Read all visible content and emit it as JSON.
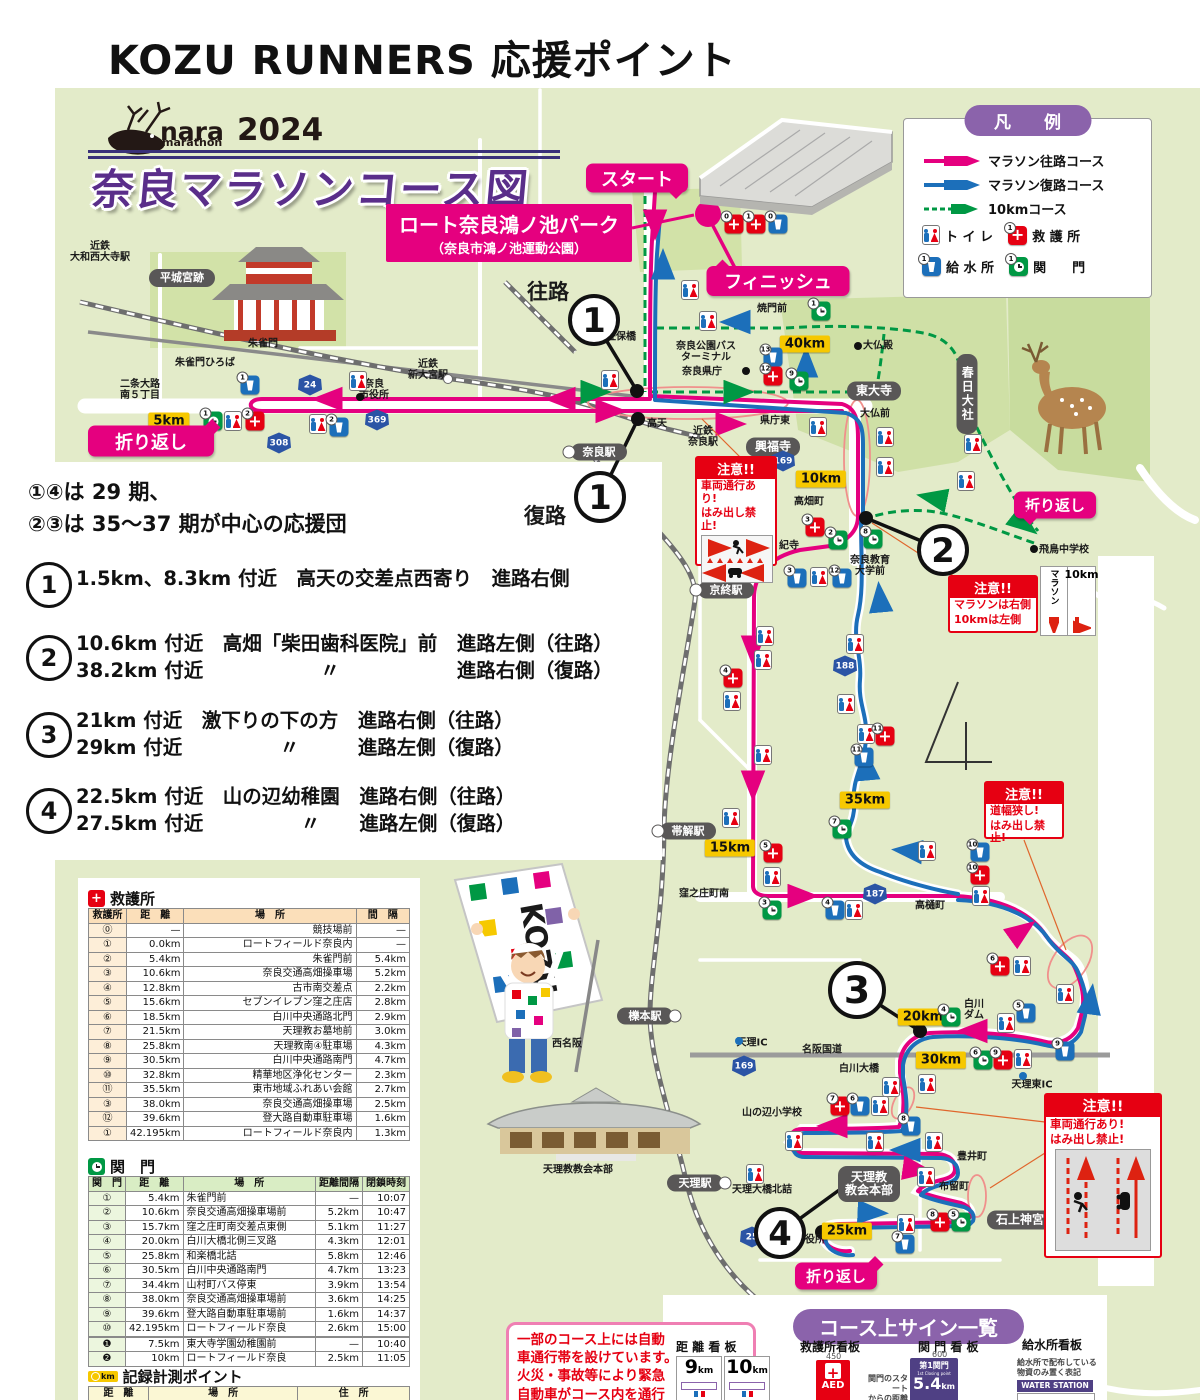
{
  "page": {
    "title": "KOZU RUNNERS 応援ポイント"
  },
  "map": {
    "logo": {
      "nara": "nara",
      "marathon": "marathon",
      "year": "2024"
    },
    "course_title": "奈良マラソンコース図",
    "venue": {
      "name": "ロート奈良鴻ノ池パーク",
      "sub": "（奈良市鴻ノ池運動公園）"
    },
    "legend": {
      "title": "凡　例",
      "items": [
        {
          "type": "pink-arrow",
          "label": "マラソン往路コース"
        },
        {
          "type": "blue-arrow",
          "label": "マラソン復路コース"
        },
        {
          "type": "green-dashed-arrow",
          "label": "10kmコース"
        }
      ],
      "icon1": {
        "label": "ト イ レ"
      },
      "icon2": {
        "label": "救 護 所"
      },
      "icon3": {
        "label": "給 水 所"
      },
      "icon4": {
        "label": "関　　門"
      }
    },
    "notes": [
      "①④は 29 期、",
      "②③は 35～37 期が中心の応援団"
    ],
    "points": [
      {
        "num": "1",
        "lines": [
          "1.5km、8.3km 付近　高天の交差点西寄り　進路右側"
        ]
      },
      {
        "num": "2",
        "lines": [
          "10.6km 付近　高畑「柴田歯科医院」前　進路左側（往路）",
          "38.2km 付近　　　　　　〃　　　　　　進路右側（復路）"
        ]
      },
      {
        "num": "3",
        "lines": [
          "21km 付近　激下りの下の方　進路右側（往路）",
          "29km 付近　　　　　〃　　　進路左側（復路）"
        ]
      },
      {
        "num": "4",
        "lines": [
          "22.5km 付近　山の辺幼稚園　進路右側（往路）",
          "27.5km 付近　　　　　〃　　進路左側（復路）"
        ]
      }
    ],
    "pills": [
      {
        "t": "スタート",
        "x": 637,
        "y": 178,
        "w": 102,
        "h": 29,
        "fs": 18,
        "tail": "br"
      },
      {
        "t": "フィニッシュ",
        "x": 778,
        "y": 281,
        "w": 143,
        "h": 30,
        "fs": 18,
        "tail": "tl"
      },
      {
        "t": "折り返し",
        "x": 151,
        "y": 441,
        "w": 126,
        "h": 31,
        "fs": 18,
        "tail": "tr"
      },
      {
        "t": "折り返し",
        "x": 1055,
        "y": 505,
        "w": 82,
        "h": 27,
        "fs": 15,
        "tail": "bl"
      },
      {
        "t": "折り返し",
        "x": 836,
        "y": 1276,
        "w": 82,
        "h": 27,
        "fs": 15,
        "tail": "tr"
      }
    ],
    "direction_labels": [
      {
        "t": "往路",
        "x": 548,
        "y": 293,
        "fs": 21
      },
      {
        "t": "復路",
        "x": 545,
        "y": 517,
        "fs": 21
      }
    ],
    "circles": [
      {
        "n": "1",
        "x": 594,
        "y": 320,
        "lx": 637,
        "ly": 391
      },
      {
        "n": "1",
        "x": 600,
        "y": 497,
        "lx": 638,
        "ly": 419
      },
      {
        "n": "2",
        "x": 943,
        "y": 550,
        "lx": 866,
        "ly": 518
      },
      {
        "n": "3",
        "x": 857,
        "y": 990,
        "lx": 920,
        "ly": 1031
      },
      {
        "n": "4",
        "x": 780,
        "y": 1233,
        "lx": 853,
        "ly": 1180,
        "dx": 822,
        "dy": 1232
      }
    ],
    "warnings": {
      "w1": {
        "title": "注意!!",
        "lines": [
          "車両通行あり!",
          "はみ出し禁止!"
        ]
      },
      "w2": {
        "title": "注意!!",
        "lines": [
          "マラソンは右側",
          "10kmは左側"
        ],
        "sign_col1": "マラソン",
        "sign_col2": "10km"
      },
      "w3": {
        "title": "注意!!",
        "lines": [
          "道幅狭し!",
          "はみ出し禁止!"
        ]
      },
      "w4": {
        "title": "注意!!",
        "lines": [
          "車両通行あり!",
          "はみ出し禁止!"
        ]
      }
    },
    "kms": [
      {
        "t": "5km",
        "x": 169,
        "y": 421
      },
      {
        "t": "40km",
        "x": 805,
        "y": 344
      },
      {
        "t": "10km",
        "x": 821,
        "y": 479
      },
      {
        "t": "15km",
        "x": 730,
        "y": 848
      },
      {
        "t": "35km",
        "x": 865,
        "y": 800
      },
      {
        "t": "20km",
        "x": 923,
        "y": 1017
      },
      {
        "t": "30km",
        "x": 941,
        "y": 1060
      },
      {
        "t": "25km",
        "x": 847,
        "y": 1231
      }
    ],
    "shields": [
      {
        "n": "24",
        "x": 310,
        "y": 385
      },
      {
        "n": "308",
        "x": 279,
        "y": 443
      },
      {
        "n": "369",
        "x": 377,
        "y": 420
      },
      {
        "n": "169",
        "x": 783,
        "y": 461
      },
      {
        "n": "188",
        "x": 845,
        "y": 666
      },
      {
        "n": "187",
        "x": 875,
        "y": 894
      },
      {
        "n": "169",
        "x": 744,
        "y": 1066
      },
      {
        "n": "25",
        "x": 752,
        "y": 1237
      }
    ],
    "plates": [
      {
        "t": "平城宮跡",
        "x": 182,
        "y": 278,
        "w": 66,
        "h": 18,
        "fs": 11
      },
      {
        "t": "興福寺",
        "x": 773,
        "y": 447,
        "w": 54,
        "h": 19,
        "fs": 12
      },
      {
        "t": "東大寺",
        "x": 874,
        "y": 391,
        "w": 54,
        "h": 19,
        "fs": 12
      },
      {
        "t": "春日大社",
        "x": 967,
        "y": 394,
        "w": 21,
        "h": 80,
        "fs": 12,
        "v": 1
      },
      {
        "t": "石上神宮",
        "x": 1020,
        "y": 1220,
        "w": 66,
        "h": 19,
        "fs": 12
      },
      {
        "t": "天理教\n教会本部",
        "x": 869,
        "y": 1184,
        "w": 62,
        "h": 36,
        "fs": 12
      },
      {
        "t": "奈良駅",
        "x": 599,
        "y": 452,
        "w": 56,
        "h": 17,
        "fs": 11,
        "dot": "l"
      },
      {
        "t": "京終駅",
        "x": 726,
        "y": 590,
        "w": 56,
        "h": 17,
        "fs": 11,
        "dot": "l"
      },
      {
        "t": "帯解駅",
        "x": 688,
        "y": 831,
        "w": 56,
        "h": 17,
        "fs": 11,
        "dot": "l"
      },
      {
        "t": "櫟本駅",
        "x": 645,
        "y": 1016,
        "w": 56,
        "h": 17,
        "fs": 11,
        "dot": "r"
      },
      {
        "t": "天理駅",
        "x": 695,
        "y": 1183,
        "w": 56,
        "h": 17,
        "fs": 11,
        "dot": "r"
      }
    ],
    "labels": [
      {
        "t": "近鉄\n大和西大寺駅",
        "x": 100,
        "y": 252,
        "fs": 10
      },
      {
        "t": "二条大路\n南５丁目",
        "x": 140,
        "y": 390,
        "fs": 10
      },
      {
        "t": "朱雀門ひろば",
        "x": 205,
        "y": 363,
        "fs": 10
      },
      {
        "t": "朱雀門",
        "x": 263,
        "y": 344,
        "fs": 10
      },
      {
        "t": "奈良\n市役所",
        "x": 374,
        "y": 390,
        "fs": 10
      },
      {
        "t": "近鉄\n新大宮駅",
        "x": 428,
        "y": 370,
        "fs": 10
      },
      {
        "t": "蓮佐保橋",
        "x": 616,
        "y": 337,
        "fs": 10
      },
      {
        "t": "高天",
        "x": 657,
        "y": 424,
        "fs": 10
      },
      {
        "t": "近鉄\n奈良駅",
        "x": 703,
        "y": 437,
        "fs": 10
      },
      {
        "t": "県庁東",
        "x": 775,
        "y": 421,
        "fs": 10
      },
      {
        "t": "大仏前",
        "x": 875,
        "y": 414,
        "fs": 10
      },
      {
        "t": "大仏殿",
        "x": 878,
        "y": 346,
        "fs": 10
      },
      {
        "t": "焼門前",
        "x": 772,
        "y": 309,
        "fs": 10
      },
      {
        "t": "奈良公園バス\nターミナル",
        "x": 706,
        "y": 352,
        "fs": 10
      },
      {
        "t": "奈良県庁",
        "x": 702,
        "y": 372,
        "fs": 10
      },
      {
        "t": "高畑町",
        "x": 809,
        "y": 502,
        "fs": 10
      },
      {
        "t": "紀寺",
        "x": 789,
        "y": 546,
        "fs": 10
      },
      {
        "t": "奈良教育\n大学前",
        "x": 870,
        "y": 566,
        "fs": 10
      },
      {
        "t": "飛鳥中学校",
        "x": 1064,
        "y": 550,
        "fs": 10
      },
      {
        "t": "窪之庄町南",
        "x": 704,
        "y": 894,
        "fs": 10
      },
      {
        "t": "高樋町",
        "x": 930,
        "y": 906,
        "fs": 10
      },
      {
        "t": "天理IC",
        "x": 752,
        "y": 1043,
        "fs": 10
      },
      {
        "t": "名阪国道",
        "x": 822,
        "y": 1050,
        "fs": 10
      },
      {
        "t": "白川大橋",
        "x": 859,
        "y": 1069,
        "fs": 10
      },
      {
        "t": "白川\nダム",
        "x": 974,
        "y": 1010,
        "fs": 10
      },
      {
        "t": "天理東IC",
        "x": 1032,
        "y": 1085,
        "fs": 10
      },
      {
        "t": "山の辺小学校",
        "x": 772,
        "y": 1113,
        "fs": 10
      },
      {
        "t": "豊井町",
        "x": 972,
        "y": 1157,
        "fs": 10
      },
      {
        "t": "布留町",
        "x": 954,
        "y": 1187,
        "fs": 10
      },
      {
        "t": "天理大橋北詰",
        "x": 762,
        "y": 1190,
        "fs": 10
      },
      {
        "t": "西名阪",
        "x": 567,
        "y": 1044,
        "fs": 10
      },
      {
        "t": "役所",
        "x": 815,
        "y": 1240,
        "fs": 10
      },
      {
        "t": "天理教教会本部",
        "x": 578,
        "y": 1170,
        "fs": 10
      }
    ],
    "dots": [
      {
        "x": 858,
        "y": 346
      },
      {
        "x": 746,
        "y": 371
      },
      {
        "x": 1034,
        "y": 549
      },
      {
        "x": 360,
        "y": 397
      },
      {
        "x": 800,
        "y": 1238
      },
      {
        "x": 448,
        "y": 379,
        "c": "w"
      },
      {
        "x": 739,
        "y": 1041,
        "c": "b"
      },
      {
        "x": 1023,
        "y": 1076,
        "c": "b"
      }
    ],
    "markers": [
      {
        "k": "t",
        "x": 690,
        "y": 290
      },
      {
        "k": "t",
        "x": 708,
        "y": 321
      },
      {
        "k": "a",
        "n": "0",
        "x": 734,
        "y": 224
      },
      {
        "k": "a",
        "n": "1",
        "x": 756,
        "y": 224
      },
      {
        "k": "w",
        "n": "0",
        "x": 778,
        "y": 224
      },
      {
        "k": "g",
        "n": "1",
        "x": 821,
        "y": 311
      },
      {
        "k": "g",
        "n": "9",
        "x": 799,
        "y": 381
      },
      {
        "k": "w",
        "n": "13",
        "x": 773,
        "y": 357
      },
      {
        "k": "a",
        "n": "12",
        "x": 773,
        "y": 376
      },
      {
        "k": "t",
        "x": 818,
        "y": 427
      },
      {
        "k": "t",
        "x": 885,
        "y": 437
      },
      {
        "k": "t",
        "x": 885,
        "y": 467
      },
      {
        "k": "t",
        "x": 973,
        "y": 444
      },
      {
        "k": "t",
        "x": 966,
        "y": 481
      },
      {
        "k": "a",
        "n": "3",
        "x": 815,
        "y": 527
      },
      {
        "k": "g",
        "n": "2",
        "x": 838,
        "y": 540
      },
      {
        "k": "g",
        "n": "8",
        "x": 873,
        "y": 539
      },
      {
        "k": "w",
        "n": "3",
        "x": 797,
        "y": 578
      },
      {
        "k": "t",
        "x": 819,
        "y": 577
      },
      {
        "k": "w",
        "n": "12",
        "x": 842,
        "y": 578
      },
      {
        "k": "t",
        "x": 610,
        "y": 380
      },
      {
        "k": "w",
        "n": "1",
        "x": 250,
        "y": 385
      },
      {
        "k": "t",
        "x": 358,
        "y": 381
      },
      {
        "k": "g",
        "n": "1",
        "x": 213,
        "y": 421
      },
      {
        "k": "t",
        "x": 233,
        "y": 421
      },
      {
        "k": "a",
        "n": "2",
        "x": 255,
        "y": 421
      },
      {
        "k": "t",
        "x": 318,
        "y": 424
      },
      {
        "k": "w",
        "n": "2",
        "x": 339,
        "y": 427
      },
      {
        "k": "t",
        "x": 765,
        "y": 636
      },
      {
        "k": "t",
        "x": 763,
        "y": 660
      },
      {
        "k": "a",
        "n": "4",
        "x": 733,
        "y": 678
      },
      {
        "k": "t",
        "x": 732,
        "y": 701
      },
      {
        "k": "t",
        "x": 763,
        "y": 755
      },
      {
        "k": "t",
        "x": 731,
        "y": 818
      },
      {
        "k": "a",
        "n": "5",
        "x": 773,
        "y": 853
      },
      {
        "k": "t",
        "x": 772,
        "y": 877
      },
      {
        "k": "g",
        "n": "7",
        "x": 842,
        "y": 829
      },
      {
        "k": "g",
        "n": "3",
        "x": 772,
        "y": 910
      },
      {
        "k": "w",
        "n": "4",
        "x": 835,
        "y": 910
      },
      {
        "k": "t",
        "x": 854,
        "y": 910
      },
      {
        "k": "t",
        "x": 855,
        "y": 644
      },
      {
        "k": "t",
        "x": 846,
        "y": 704
      },
      {
        "k": "t",
        "x": 866,
        "y": 734
      },
      {
        "k": "a",
        "n": "11",
        "x": 885,
        "y": 736
      },
      {
        "k": "w",
        "n": "11",
        "x": 864,
        "y": 757
      },
      {
        "k": "t",
        "x": 927,
        "y": 851
      },
      {
        "k": "w",
        "n": "10",
        "x": 980,
        "y": 852
      },
      {
        "k": "a",
        "n": "10",
        "x": 980,
        "y": 875
      },
      {
        "k": "t",
        "x": 981,
        "y": 896
      },
      {
        "k": "a",
        "n": "6",
        "x": 1000,
        "y": 966
      },
      {
        "k": "t",
        "x": 1022,
        "y": 966
      },
      {
        "k": "t",
        "x": 1065,
        "y": 994
      },
      {
        "k": "w",
        "n": "5",
        "x": 1026,
        "y": 1013
      },
      {
        "k": "t",
        "x": 1006,
        "y": 1023
      },
      {
        "k": "g",
        "n": "4",
        "x": 951,
        "y": 1017
      },
      {
        "k": "g",
        "n": "6",
        "x": 983,
        "y": 1060
      },
      {
        "k": "a",
        "n": "9",
        "x": 1003,
        "y": 1060
      },
      {
        "k": "t",
        "x": 1023,
        "y": 1059
      },
      {
        "k": "w",
        "n": "9",
        "x": 1065,
        "y": 1051
      },
      {
        "k": "t",
        "x": 891,
        "y": 1087
      },
      {
        "k": "t",
        "x": 927,
        "y": 1084
      },
      {
        "k": "a",
        "n": "7",
        "x": 840,
        "y": 1106
      },
      {
        "k": "w",
        "n": "6",
        "x": 860,
        "y": 1106
      },
      {
        "k": "t",
        "x": 880,
        "y": 1106
      },
      {
        "k": "w",
        "n": "8",
        "x": 911,
        "y": 1126
      },
      {
        "k": "t",
        "x": 794,
        "y": 1141
      },
      {
        "k": "t",
        "x": 875,
        "y": 1142
      },
      {
        "k": "t",
        "x": 934,
        "y": 1142
      },
      {
        "k": "t",
        "x": 755,
        "y": 1174
      },
      {
        "k": "t",
        "x": 926,
        "y": 1177
      },
      {
        "k": "t",
        "x": 906,
        "y": 1224
      },
      {
        "k": "a",
        "n": "8",
        "x": 940,
        "y": 1222
      },
      {
        "k": "g",
        "n": "5",
        "x": 961,
        "y": 1222
      },
      {
        "k": "w",
        "n": "7",
        "x": 905,
        "y": 1244
      }
    ]
  },
  "tables": {
    "aid": {
      "title": "救護所",
      "headers": [
        "救護所",
        "距　離",
        "場　所",
        "間　隔"
      ],
      "rows": [
        [
          "⓪",
          "—",
          "競技場前",
          "—"
        ],
        [
          "①",
          "0.0km",
          "ロートフィールド奈良内",
          "—"
        ],
        [
          "②",
          "5.4km",
          "朱雀門前",
          "5.4km"
        ],
        [
          "③",
          "10.6km",
          "奈良交通高畑操車場",
          "5.2km"
        ],
        [
          "④",
          "12.8km",
          "古市南交差点",
          "2.2km"
        ],
        [
          "⑤",
          "15.6km",
          "セブンイレブン窪之庄店",
          "2.8km"
        ],
        [
          "⑥",
          "18.5km",
          "白川中央通路北門",
          "2.9km"
        ],
        [
          "⑦",
          "21.5km",
          "天理教お墓地前",
          "3.0km"
        ],
        [
          "⑧",
          "25.8km",
          "天理教南④駐車場",
          "4.3km"
        ],
        [
          "⑨",
          "30.5km",
          "白川中央通路南門",
          "4.7km"
        ],
        [
          "⑩",
          "32.8km",
          "精華地区浄化センター",
          "2.3km"
        ],
        [
          "⑪",
          "35.5km",
          "東市地域ふれあい会館",
          "2.7km"
        ],
        [
          "③",
          "38.0km",
          "奈良交通高畑操車場",
          "2.5km"
        ],
        [
          "⑫",
          "39.6km",
          "登大路自動車駐車場",
          "1.6km"
        ],
        [
          "①",
          "42.195km",
          "ロートフィールド奈良内",
          "1.3km"
        ]
      ]
    },
    "gate": {
      "title": "関　門",
      "headers": [
        "関　門",
        "距　離",
        "場　所",
        "距離間隔",
        "閉鎖時刻"
      ],
      "rows": [
        [
          "①",
          "5.4km",
          "朱雀門前",
          "—",
          "10:07"
        ],
        [
          "②",
          "10.6km",
          "奈良交通高畑操車場前",
          "5.2km",
          "10:47"
        ],
        [
          "③",
          "15.7km",
          "窪之庄町南交差点東側",
          "5.1km",
          "11:27"
        ],
        [
          "④",
          "20.0km",
          "白川大橋北側三叉路",
          "4.3km",
          "12:01"
        ],
        [
          "⑤",
          "25.8km",
          "和楽橋北詰",
          "5.8km",
          "12:46"
        ],
        [
          "⑥",
          "30.5km",
          "白川中央通路南門",
          "4.7km",
          "13:23"
        ],
        [
          "⑦",
          "34.4km",
          "山村町バス停東",
          "3.9km",
          "13:54"
        ],
        [
          "⑧",
          "38.0km",
          "奈良交通高畑操車場前",
          "3.6km",
          "14:25"
        ],
        [
          "⑨",
          "39.6km",
          "登大路自動車駐車場前",
          "1.6km",
          "14:37"
        ],
        [
          "⑩",
          "42.195km",
          "ロートフィールド奈良",
          "2.6km",
          "15:00"
        ]
      ],
      "sub_rows": [
        [
          "❶",
          "7.5km",
          "東大寺学園幼稚園前",
          "—",
          "10:40"
        ],
        [
          "❷",
          "10km",
          "ロートフィールド奈良",
          "2.5km",
          "11:05"
        ]
      ]
    },
    "record": {
      "title": "記録計測ポイント",
      "icon": "km",
      "headers": [
        "距　離",
        "場　所",
        "住　所"
      ],
      "rows": []
    }
  },
  "notice_box": {
    "lines": [
      "一部のコース上には自動",
      "車通行帯を設けています。",
      "火災・事故等により緊急",
      "自動車がコース内を通行",
      "する場合には緊急自動車"
    ]
  },
  "signs": {
    "header": "コース上サイン一覧",
    "distance": {
      "label": "距 離 看 板",
      "sign1": "9",
      "sign2": "10",
      "unit": "km"
    },
    "aid": {
      "label": "救護所看板",
      "dim": "450",
      "text": "AED"
    },
    "gate": {
      "label": "関 門 看 板",
      "dim": "600",
      "top": "第1関門",
      "sub": "1st Closing point",
      "value": "5.4",
      "unit": "km",
      "note": [
        "関門のスタート",
        "からの距離"
      ]
    },
    "water": {
      "label": "給水所看板",
      "note": [
        "給水所で配布している",
        "物資のみ置く表記"
      ],
      "bar": "WATER STATION"
    }
  }
}
